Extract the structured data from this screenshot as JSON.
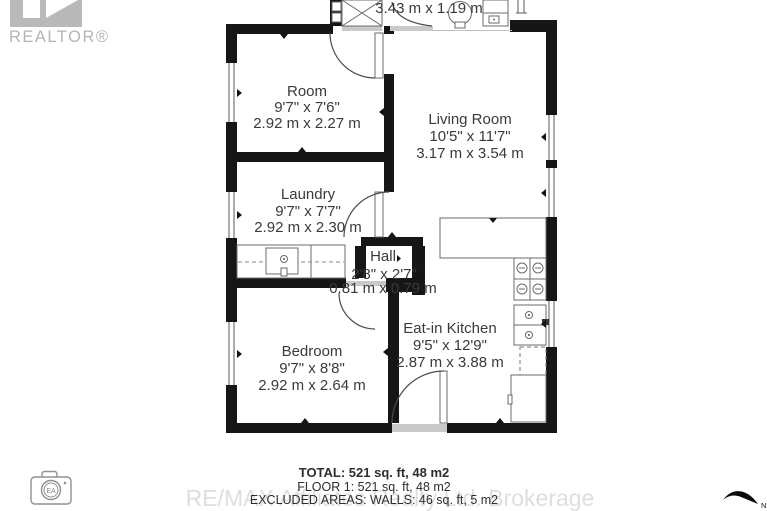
{
  "branding": {
    "realtor_label": "REALTOR®",
    "watermark": "RE/MAX Affiliates Realty Ltd. Brokerage",
    "camera_badge": "EA",
    "compass_label": "N"
  },
  "floorplan": {
    "top_room": {
      "metric": "3.43 m x 1.19 m"
    },
    "rooms": {
      "room": {
        "name": "Room",
        "imperial": "9'7\" x 7'6\"",
        "metric": "2.92 m x 2.27 m"
      },
      "living": {
        "name": "Living Room",
        "imperial": "10'5\" x 11'7\"",
        "metric": "3.17 m x 3.54 m"
      },
      "laundry": {
        "name": "Laundry",
        "imperial": "9'7\" x 7'7\"",
        "metric": "2.92 m x 2.30 m"
      },
      "hall": {
        "name": "Hall",
        "imperial": "2'8\" x 2'7\"",
        "metric": "0.81 m x 0.79 m"
      },
      "bedroom": {
        "name": "Bedroom",
        "imperial": "9'7\" x 8'8\"",
        "metric": "2.92 m x 2.64 m"
      },
      "kitchen": {
        "name": "Eat-in Kitchen",
        "imperial": "9'5\" x 12'9\"",
        "metric": "2.87 m x 3.88 m"
      }
    }
  },
  "summary": {
    "total": "TOTAL: 521 sq. ft, 48 m2",
    "floor1": "FLOOR 1: 521 sq. ft, 48 m2",
    "excluded": "EXCLUDED AREAS: WALLS: 46 sq. ft, 5 m2"
  }
}
